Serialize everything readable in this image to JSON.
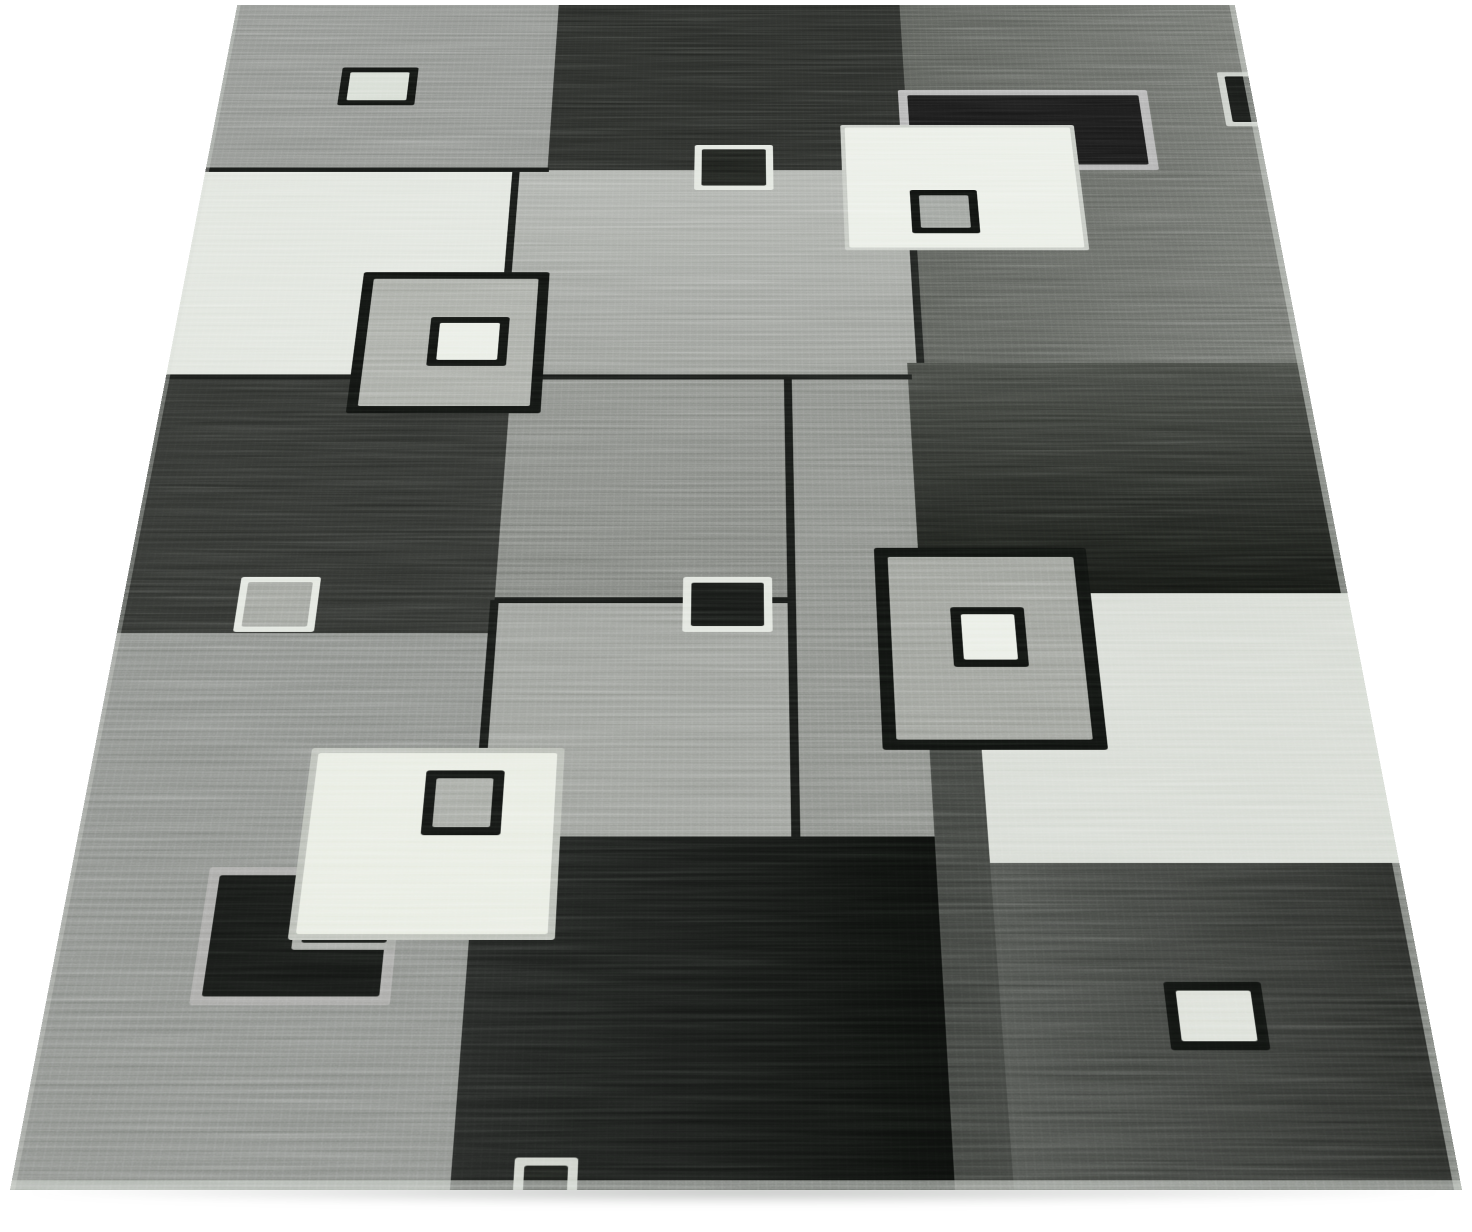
{
  "scene": {
    "background": "#ffffff",
    "description": "Angled product photograph of a modern geometric patchwork area rug in mottled shades of gray, charcoal, black and cream, decorated with small carved square motifs, lying on a white floor"
  },
  "rug": {
    "perspective": {
      "distance_px": 2651,
      "tilt_deg": 35,
      "origin_x": 736,
      "bottom_y": 1190,
      "width": 1452,
      "height": 2106
    },
    "palette": {
      "black": "#0d0f0d",
      "charcoal": "#262825",
      "dark_gray": "#41443f",
      "mid_gray": "#8b8e89",
      "light_gray": "#aeb1ac",
      "cream": "#e8ece3",
      "white_band": "#e0e4dd"
    },
    "ground_shadow": {
      "x": 30,
      "y": 1183,
      "w": 1408,
      "h": 22
    },
    "blocks": [
      {
        "name": "top-left-gray",
        "x": 0,
        "y": 0,
        "w": 468,
        "h": 402,
        "c": "#8f928e"
      },
      {
        "name": "top-mid-charcoal",
        "x": 468,
        "y": 0,
        "w": 496,
        "h": 402,
        "c": "#262825"
      },
      {
        "name": "right-column-gray",
        "x": 964,
        "y": 0,
        "w": 488,
        "h": 814,
        "c": "#565954",
        "c2": "#6e716c",
        "dir": "90deg"
      },
      {
        "name": "left-white-band",
        "x": 0,
        "y": 402,
        "w": 425,
        "h": 440,
        "c": "#e0e4dd"
      },
      {
        "name": "center-light-gray",
        "x": 425,
        "y": 402,
        "w": 539,
        "h": 440,
        "c": "#aeb1ac",
        "c2": "#979a95",
        "dir": "180deg"
      },
      {
        "name": "left-dark-charcoal",
        "x": 0,
        "y": 842,
        "w": 440,
        "h": 467,
        "c": "#2c2e2b"
      },
      {
        "name": "center-mid-gray",
        "x": 440,
        "y": 842,
        "w": 352,
        "h": 411,
        "c": "#8b8e89",
        "c2": "#7d807b",
        "dir": "180deg"
      },
      {
        "name": "mid-column-gray",
        "x": 792,
        "y": 842,
        "w": 153,
        "h": 788,
        "c": "#898c87"
      },
      {
        "name": "right-dark-block",
        "x": 945,
        "y": 814,
        "w": 507,
        "h": 427,
        "c": "#41443f",
        "c2": "#111310",
        "dir": "180deg"
      },
      {
        "name": "center-gray-lower",
        "x": 440,
        "y": 1253,
        "w": 352,
        "h": 377,
        "c": "#9a9d98"
      },
      {
        "name": "left-bottom-gray",
        "x": 0,
        "y": 1309,
        "w": 440,
        "h": 797,
        "c": "#8b8e8a"
      },
      {
        "name": "right-light-block",
        "x": 1004,
        "y": 1241,
        "w": 448,
        "h": 428,
        "c": "#d6dad3"
      },
      {
        "name": "mid-dark-strip",
        "x": 945,
        "y": 1241,
        "w": 59,
        "h": 865,
        "c": "#3a3d39"
      },
      {
        "name": "bottom-black-block",
        "x": 440,
        "y": 1630,
        "w": 505,
        "h": 476,
        "c": "#202220",
        "c2": "#0a0c0a",
        "dir": "90deg"
      },
      {
        "name": "bottom-right-dark",
        "x": 1004,
        "y": 1669,
        "w": 448,
        "h": 437,
        "c": "#4b4e4a",
        "c2": "#242623",
        "dir": "90deg"
      }
    ],
    "seams": [
      {
        "x": 0,
        "y": 396,
        "w": 470,
        "h": 10,
        "c": "#121412"
      },
      {
        "x": 0,
        "y": 837,
        "w": 950,
        "h": 10,
        "c": "#151715"
      },
      {
        "x": 420,
        "y": 402,
        "w": 10,
        "h": 440,
        "c": "#131513"
      },
      {
        "x": 787,
        "y": 842,
        "w": 10,
        "h": 788,
        "c": "#131513"
      },
      {
        "x": 440,
        "y": 1248,
        "w": 352,
        "h": 10,
        "c": "#131513"
      },
      {
        "x": 957,
        "y": 402,
        "w": 10,
        "h": 412,
        "c": "#1b1d1b"
      },
      {
        "x": 435,
        "y": 1253,
        "w": 10,
        "h": 377,
        "c": "#131513"
      }
    ],
    "motifs": [
      {
        "name": "top-right-double-frame",
        "x": 954,
        "y": 213,
        "w": 351,
        "h": 189,
        "frame": "#b2b2b2",
        "fw": 13,
        "fill": "#161616",
        "inner": {
          "x": 125,
          "y": 84,
          "w": 107,
          "h": 89,
          "frame": "#a8a8a8",
          "fw": 10,
          "fill": "#131513"
        }
      },
      {
        "name": "upper-white-square",
        "x": 871,
        "y": 297,
        "w": 325,
        "h": 283,
        "frame": "#c3c7c0",
        "fw": 6,
        "fill": "#eaeee6",
        "inner": {
          "x": 91,
          "y": 150,
          "w": 91,
          "h": 96,
          "frame": "#0d0f0d",
          "fw": 12,
          "fill": "#9ca09b"
        }
      },
      {
        "name": "top-left-light-square",
        "x": 167,
        "y": 158,
        "w": 108,
        "h": 92,
        "frame": "#0f110f",
        "fw": 12,
        "fill": "#d6dcd3"
      },
      {
        "name": "top-black-square",
        "x": 669,
        "y": 344,
        "w": 108,
        "h": 103,
        "frame": "#e1e5de",
        "fw": 10,
        "fill": "#1b1d1a"
      },
      {
        "name": "right-edge-partial-square",
        "x": 1408,
        "y": 170,
        "w": 70,
        "h": 130,
        "frame": "#c9cdc7",
        "fw": 10,
        "fill": "#141614"
      },
      {
        "name": "left-gray-square",
        "x": 235,
        "y": 627,
        "w": 245,
        "h": 286,
        "frame": "#0e100e",
        "fw": 14,
        "fill": "#a7aaa4",
        "inner": {
          "x": 95,
          "y": 94,
          "w": 102,
          "h": 99,
          "frame": "#0e100e",
          "fw": 12,
          "fill": "#e9ede5"
        }
      },
      {
        "name": "center-black-square",
        "x": 663,
        "y": 1213,
        "w": 106,
        "h": 94,
        "frame": "#e0e4dd",
        "fw": 10,
        "fill": "#141614"
      },
      {
        "name": "left-small-gray-square",
        "x": 136,
        "y": 1213,
        "w": 95,
        "h": 94,
        "frame": "#e2e6df",
        "fw": 9,
        "fill": "#9ea19b"
      },
      {
        "name": "center-right-gray-square",
        "x": 892,
        "y": 1162,
        "w": 255,
        "h": 336,
        "frame": "#0d0f0d",
        "fw": 16,
        "fill": "#9b9e98",
        "inner": {
          "x": 87,
          "y": 103,
          "w": 87,
          "h": 100,
          "frame": "#0d0f0d",
          "fw": 12,
          "fill": "#e9ede5"
        }
      },
      {
        "name": "bottom-left-double-square",
        "x": 151,
        "y": 1675,
        "w": 211,
        "h": 194,
        "frame": "#a7a7a5",
        "fw": 12,
        "fill": "#131513",
        "inner": {
          "x": 100,
          "y": 0,
          "w": 111,
          "h": 118,
          "frame": "#9fa29d",
          "fw": 10,
          "fill": "#141614"
        }
      },
      {
        "name": "bottom-cream-square",
        "x": 246,
        "y": 1495,
        "w": 286,
        "h": 284,
        "frame": "#b8bcb4",
        "fw": 8,
        "fill": "#e8ece2",
        "inner": {
          "x": 132,
          "y": 35,
          "w": 88,
          "h": 98,
          "frame": "#101210",
          "fw": 12,
          "fill": "#a4a7a1"
        }
      },
      {
        "name": "bottom-right-white-square",
        "x": 1178,
        "y": 1837,
        "w": 103,
        "h": 92,
        "frame": "#0d0f0d",
        "fw": 12,
        "fill": "#dbdfd7"
      },
      {
        "name": "bottom-edge-partial-square",
        "x": 503,
        "y": 2066,
        "w": 64,
        "h": 80,
        "frame": "#cdd1c9",
        "fw": 10,
        "fill": "#1a1c19"
      }
    ],
    "edge_highlights": [
      {
        "x": 1444,
        "y": 0,
        "w": 8,
        "h": 2106,
        "c": "rgba(214,219,211,0.5)"
      },
      {
        "x": 0,
        "y": 2094,
        "w": 1452,
        "h": 12,
        "c": "rgba(212,217,210,0.55)"
      },
      {
        "x": 0,
        "y": 0,
        "w": 5,
        "h": 2106,
        "c": "rgba(214,219,211,0.3)"
      }
    ]
  }
}
